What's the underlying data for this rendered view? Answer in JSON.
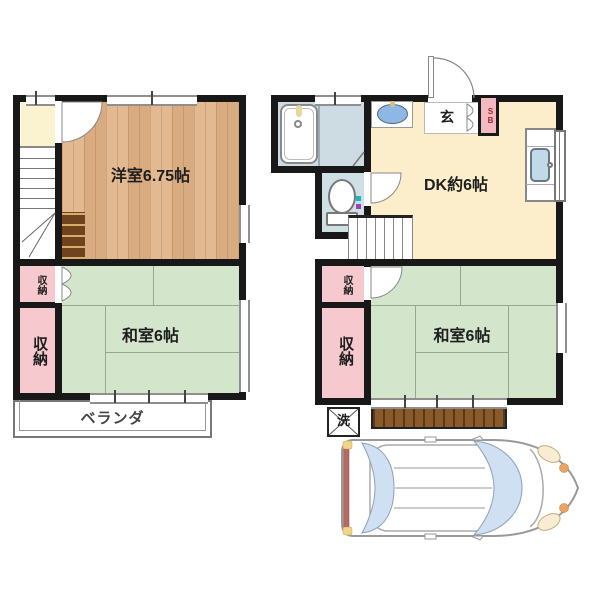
{
  "floor2": {
    "western_room": "洋室6.75帖",
    "japanese_room": "和室6帖",
    "closet_small": "収納",
    "closet_large": "収納",
    "veranda": "ベランダ"
  },
  "floor1": {
    "dk": "DK約6帖",
    "entrance": "玄",
    "shoebox": "SB",
    "japanese_room": "和室6帖",
    "closet_small": "収納",
    "closet_large": "収納",
    "laundry": "洗"
  },
  "colors": {
    "wall": "#181818",
    "wood_floor": "#dfb184",
    "tatami_green": "#d3e5cb",
    "closet_pink": "#f5c9ce",
    "closet_cream": "#fbf2cf",
    "dk_cream": "#fceeca",
    "bath_blue": "#ccdce2",
    "toilet_blue": "#cfe0e4",
    "basin_blue": "#8db8e6",
    "sink_blue": "#c2d9e8",
    "deck_brown": "#8a5a2a",
    "shoebox_pink": "#f2b9c2",
    "shoebox_text": "#a02828",
    "car_glass": "#cfe0f2",
    "car_tail": "#b26b63"
  }
}
